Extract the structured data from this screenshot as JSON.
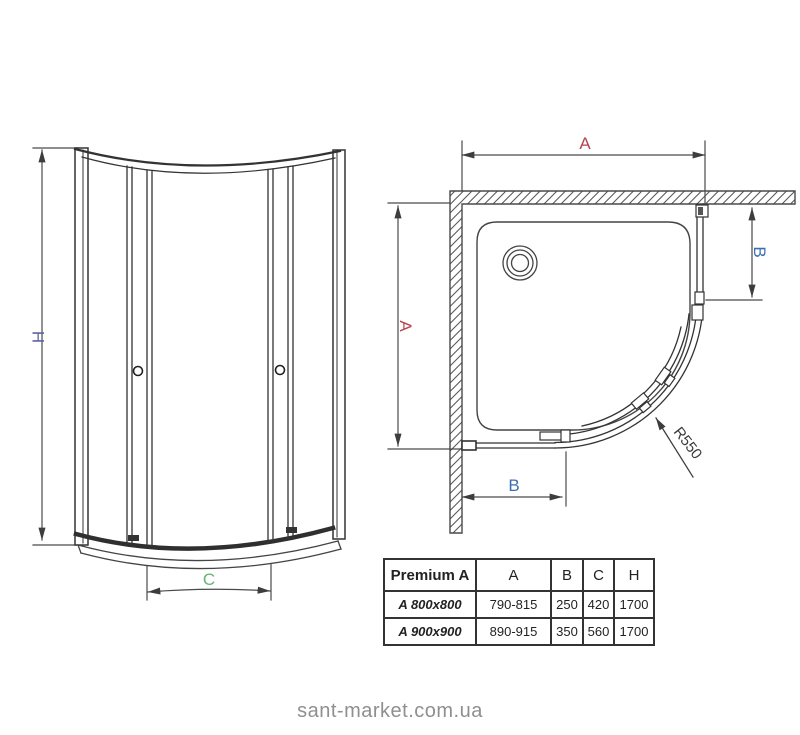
{
  "drawing": {
    "front_view": {
      "height_label": "H",
      "width_label": "C"
    },
    "top_view": {
      "width_label": "A",
      "depth_label": "A",
      "side_offset_label": "B",
      "front_offset_label": "B",
      "radius_label": "R550"
    }
  },
  "table": {
    "title": "Premium A",
    "columns": [
      "A",
      "B",
      "C",
      "H"
    ],
    "rows": [
      {
        "model": "A 800x800",
        "A": "790-815",
        "B": "250",
        "C": "420",
        "H": "1700"
      },
      {
        "model": "A 900x900",
        "A": "890-915",
        "B": "350",
        "C": "560",
        "H": "1700"
      }
    ]
  },
  "watermark": "sant-market.com.ua",
  "colors": {
    "dim_a_red": "#b5434c",
    "dim_b_blue": "#3d6fae",
    "dim_c_green": "#63b573",
    "dim_h_slate": "#5d67a1",
    "line_dark": "#333333",
    "dimension_line": "#4a4a4a",
    "watermark_gray": "#8f8f8f"
  }
}
